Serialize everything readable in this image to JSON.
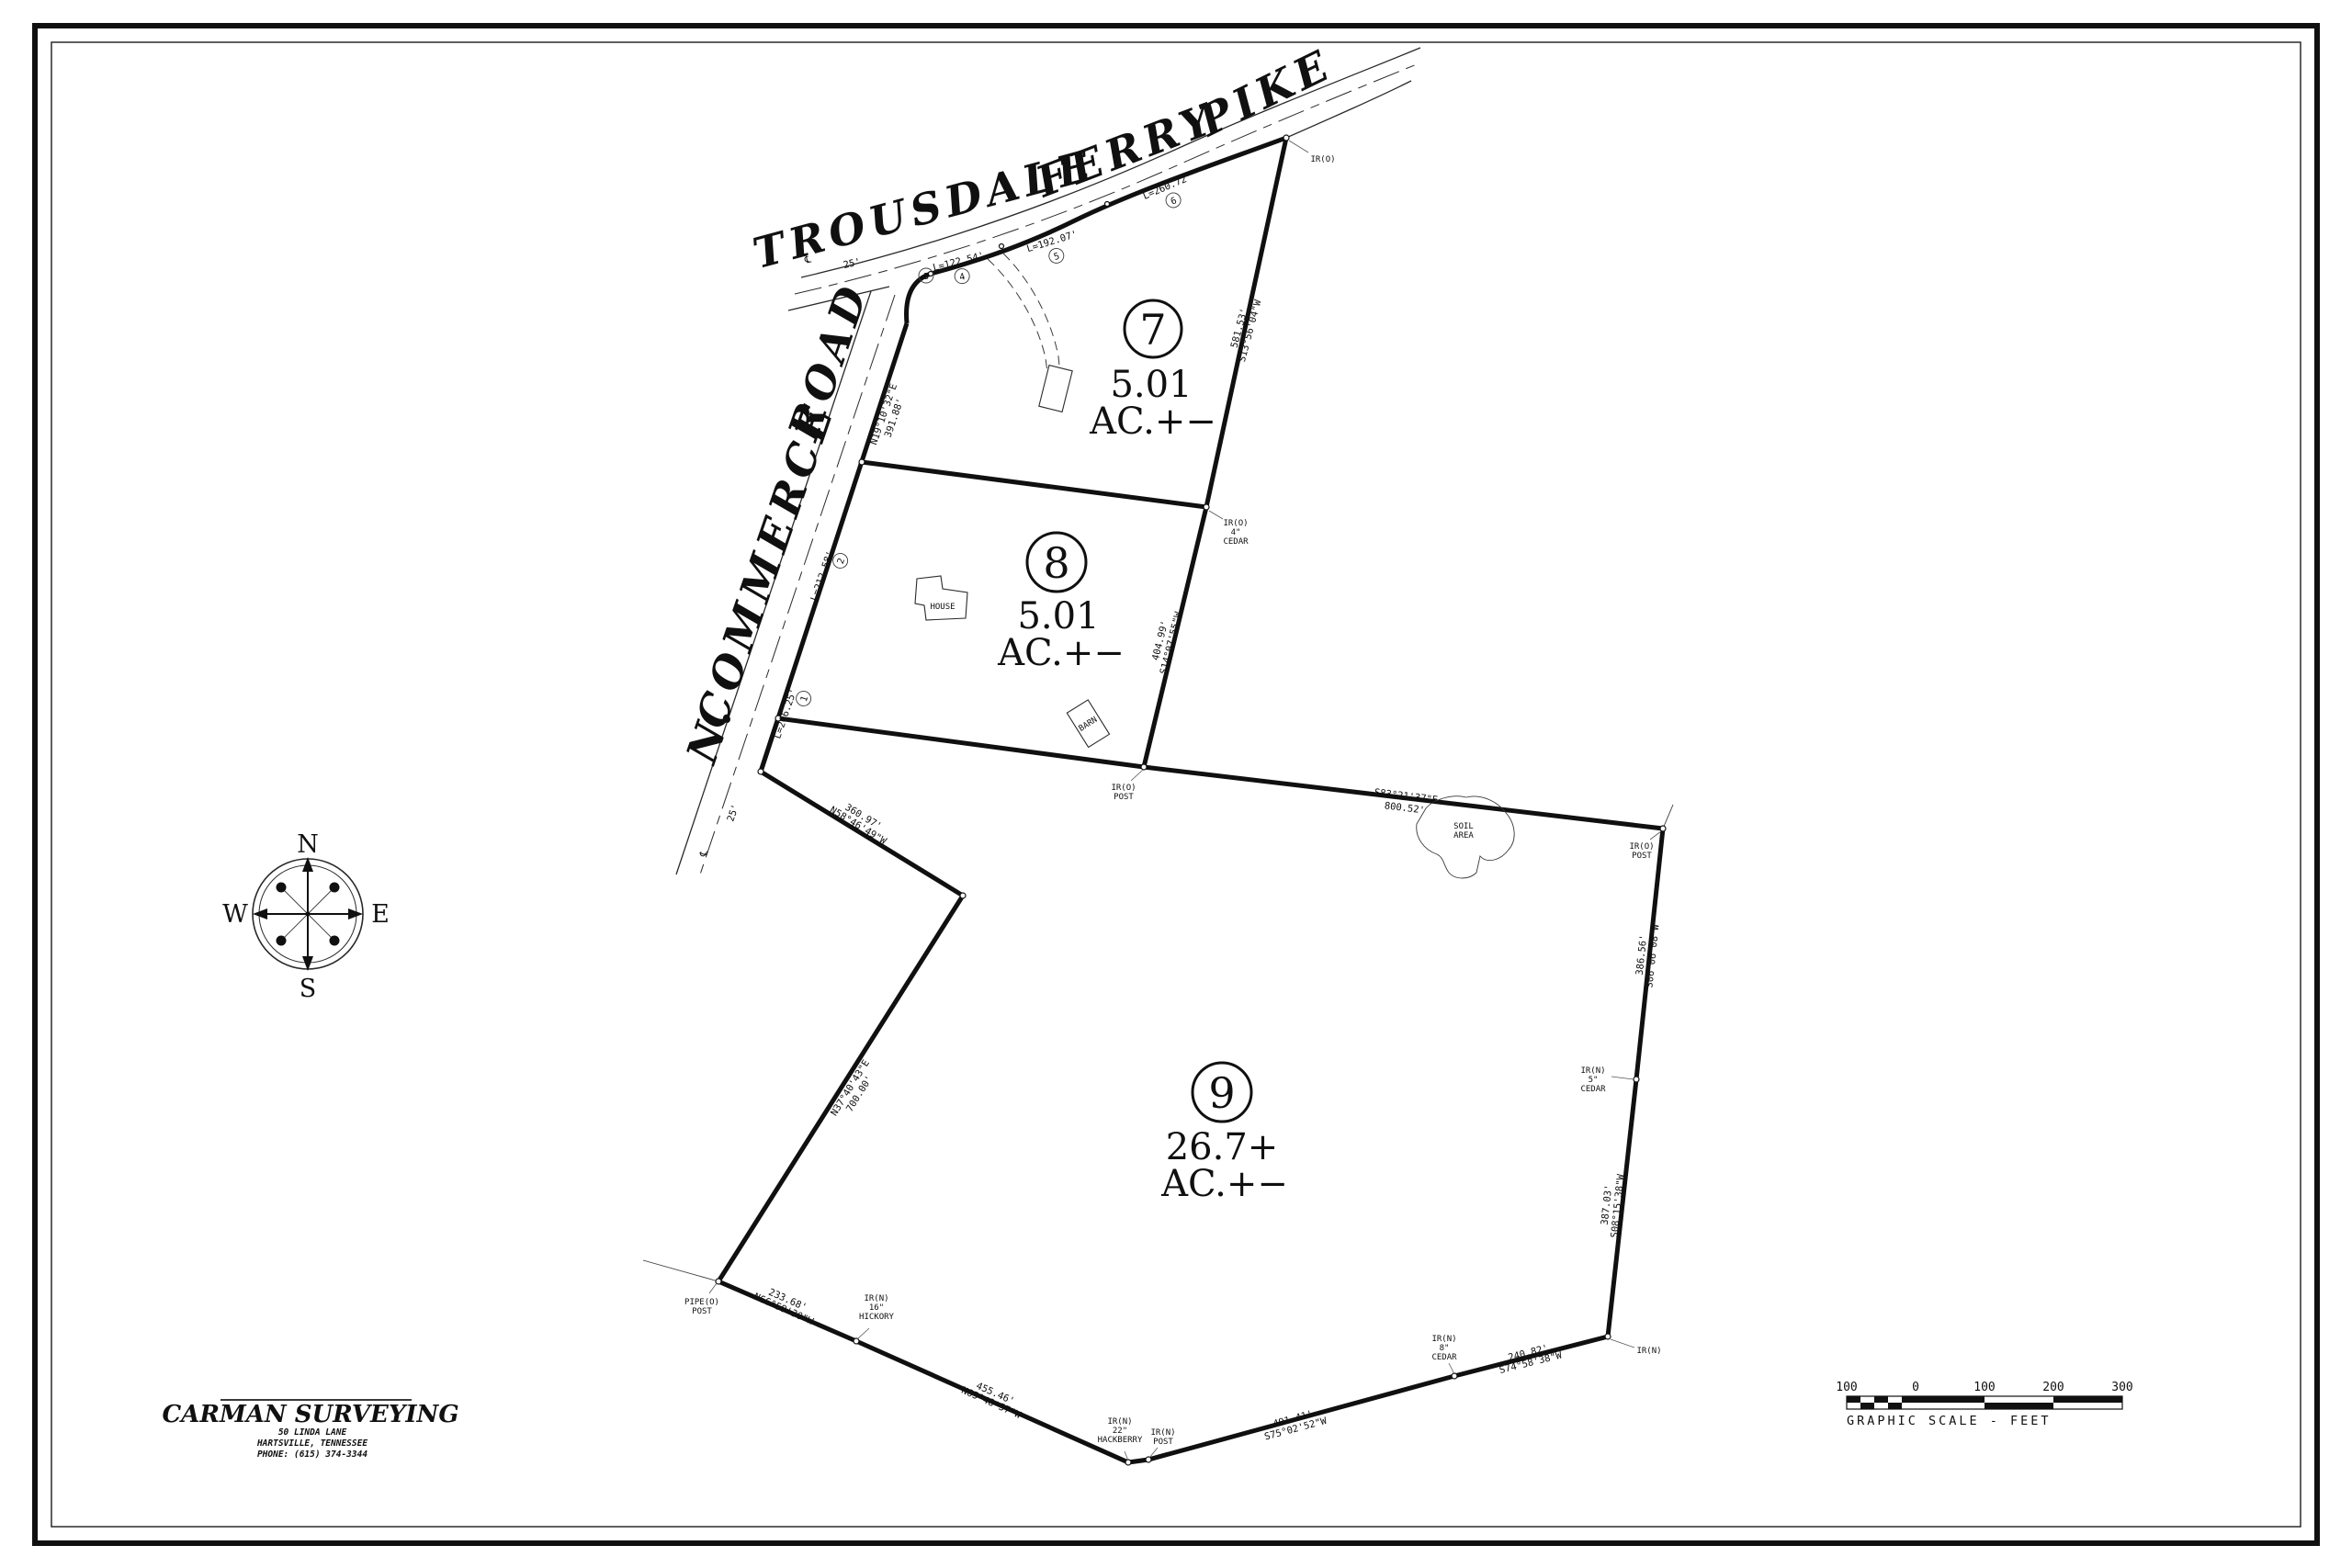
{
  "drawing": {
    "roads": {
      "trousdale": [
        "TROUSDALE",
        "FERRY",
        "PIKE"
      ],
      "commerce": [
        "N.",
        "COMMERCE",
        "ROAD"
      ],
      "row_width": "25'",
      "centerline_symbol": "℄"
    },
    "lots": [
      {
        "num": "7",
        "area": "5.01",
        "suffix": "AC.+−"
      },
      {
        "num": "8",
        "area": "5.01",
        "suffix": "AC.+−"
      },
      {
        "num": "9",
        "area": "26.7+",
        "suffix": "AC.+−"
      }
    ],
    "curves": [
      {
        "label": "L=206.25'",
        "n": "1"
      },
      {
        "label": "L=212.58'",
        "n": "2"
      },
      {
        "label": "",
        "n": "3"
      },
      {
        "label": "L=122.54'",
        "n": "4"
      },
      {
        "label": "L=192.07'",
        "n": "5"
      },
      {
        "label": "L=260.72'",
        "n": "6"
      }
    ],
    "bearings": {
      "road_frontage": {
        "b": "N19°10'32\"E",
        "d": "391.88'"
      },
      "lot7_east": {
        "d": "581.53'",
        "b": "S13°56'04\"W"
      },
      "lot8_east": {
        "d": "404.99'",
        "b": "S14°07'55\"W"
      },
      "lot9_top": {
        "b": "S83°21'37\"E",
        "d": "800.52'"
      },
      "lot9_east_upper": {
        "d": "386.56'",
        "b": "S06°06'08\"W"
      },
      "lot9_east_lower": {
        "d": "387.03'",
        "b": "S08°15'38\"W"
      },
      "lot9_south_east": {
        "d": "240.82'",
        "b": "S74°58'38\"W"
      },
      "lot9_south": {
        "d": "491.41'",
        "b": "S75°02'52\"W"
      },
      "lot9_southwest_lower": {
        "d": "455.46'",
        "b": "N65°48'57\"W"
      },
      "lot9_southwest_upper": {
        "d": "233.68'",
        "b": "N66°59'30\"W"
      },
      "lot9_west": {
        "b": "N37°40'43\"E",
        "d": "700.00'"
      },
      "lot9_northwest": {
        "d": "360.97'",
        "b": "N58°46'49\"W"
      }
    },
    "markers": {
      "pike_corner": [
        "IR(O)"
      ],
      "lot7_se": [
        "IR(O)",
        "4\"",
        "CEDAR"
      ],
      "lot9_nw_post": [
        "IR(O)",
        "POST"
      ],
      "lot9_ne_post": [
        "IR(O)",
        "POST"
      ],
      "cedar5": [
        "IR(N)",
        "5\"",
        "CEDAR"
      ],
      "irn": [
        "IR(N)"
      ],
      "cedar8": [
        "IR(N)",
        "8\"",
        "CEDAR"
      ],
      "post_s": [
        "IR(N)",
        "POST"
      ],
      "hackberry": [
        "IR(N)",
        "22\"",
        "HACKBERRY"
      ],
      "hickory": [
        "IR(N)",
        "16\"",
        "HICKORY"
      ],
      "pipe_post": [
        "PIPE(O)",
        "POST"
      ]
    },
    "features": {
      "house": "HOUSE",
      "barn": "BARN",
      "soil": [
        "SOIL",
        "AREA"
      ]
    },
    "compass": {
      "n": "N",
      "s": "S",
      "e": "E",
      "w": "W"
    },
    "title_block": {
      "company": "CARMAN SURVEYING",
      "address1": "50 LINDA LANE",
      "address2": "HARTSVILLE, TENNESSEE",
      "phone": "PHONE: (615) 374-3344"
    },
    "scale_bar": {
      "labels": [
        "100",
        "0",
        "100",
        "200",
        "300"
      ],
      "caption": "GRAPHIC SCALE - FEET"
    }
  }
}
